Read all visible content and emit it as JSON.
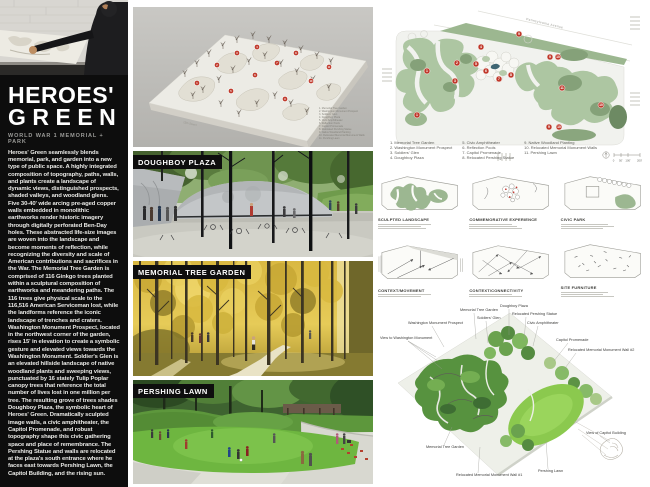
{
  "titleblock": {
    "title_line1": "HEROES'",
    "title_line2": "GREEN",
    "subtitle": "WORLD WAR 1 MEMORIAL + PARK",
    "body": "Heroes' Green seamlessly blends memorial, park, and garden into a new type of public space. A highly integrated composition of topography, paths, walls, and plants create a landscape of dynamic views, distinguished prospects, shaded valleys, and woodland glens. Five 30-40' wide arcing pre-aged copper walls embedded in monolithic earthworks render historic imagery through digitally perforated Ben-Day holes. These abstracted life-size images are woven into the landscape and become moments of reflection, while recognizing the diversity and scale of American contributions and sacrifices in the War. The Memorial Tree Garden is comprised of 116 Ginkgo trees planted within a sculptural composition of earthworks and meandering paths. The 116 trees give physical scale to the 116,516 American Serviceman lost, while the landforms reference the iconic landscape of trenches and craters. Washington Monument Prospect, located in the northwest corner of the garden, rises 15' in elevation to create a symbolic gesture and elevated views towards the Washington Monument. Soldier's Glen is an elevated hillside landscape of native woodland plants and sweeping views, punctuated by 16 stately Tulip Poplar canopy trees that reference the total number of lives lost in one million per tree. The resulting grove of trees shades Doughboy Plaza, the symbolic heart of Heroes' Green. Dramatically sculpted image walls, a civic amphitheater, the Capitol Promenade, and robust topography shape this civic gathering space and place of remembrance. The Pershing Statue and walls are relocated at the plaza's south entrance where he faces east towards Pershing Lawn, the Capitol Building, and the rising sun."
  },
  "renders": {
    "doughboy_label": "DOUGHBOY PLAZA",
    "tree_garden_label": "MEMORIAL TREE GARDEN",
    "pershing_label": "PERSHING LAWN"
  },
  "model_photo": {
    "street_caption": "15th Street",
    "markers": [
      {
        "n": "1",
        "x": 64,
        "y": 76
      },
      {
        "n": "2",
        "x": 84,
        "y": 58
      },
      {
        "n": "3",
        "x": 104,
        "y": 46
      },
      {
        "n": "4",
        "x": 124,
        "y": 40
      },
      {
        "n": "5",
        "x": 98,
        "y": 84
      },
      {
        "n": "6",
        "x": 122,
        "y": 68
      },
      {
        "n": "7",
        "x": 144,
        "y": 56
      },
      {
        "n": "8",
        "x": 163,
        "y": 46
      },
      {
        "n": "9",
        "x": 152,
        "y": 92
      },
      {
        "n": "10",
        "x": 178,
        "y": 74
      },
      {
        "n": "11",
        "x": 196,
        "y": 60
      }
    ]
  },
  "site_plan": {
    "avenue_label": "Pennsylvania Avenue",
    "legend_col1": [
      {
        "n": "1.",
        "t": "Memorial Tree Garden"
      },
      {
        "n": "2.",
        "t": "Washington Monument Prospect"
      },
      {
        "n": "3.",
        "t": "Soldiers' Glen"
      },
      {
        "n": "4.",
        "t": "Doughboy Plaza"
      }
    ],
    "legend_col2": [
      {
        "n": "5.",
        "t": "Civic Amphitheater"
      },
      {
        "n": "6.",
        "t": "Reflection Pools"
      },
      {
        "n": "7.",
        "t": "Capitol Promenade"
      },
      {
        "n": "8.",
        "t": "Relocated Pershing Statue"
      }
    ],
    "legend_col3": [
      {
        "n": "9.",
        "t": "Native Woodland Planting"
      },
      {
        "n": "10.",
        "t": "Relocated Memorial Monument Walls"
      },
      {
        "n": "11.",
        "t": "Pershing Lawn"
      }
    ],
    "scale_labels": [
      "0",
      "50'",
      "100'",
      "200'"
    ],
    "markers": [
      {
        "n": "1",
        "x": 49,
        "y": 64
      },
      {
        "n": "2",
        "x": 79,
        "y": 56
      },
      {
        "n": "3",
        "x": 77,
        "y": 74
      },
      {
        "n": "1",
        "x": 39,
        "y": 108
      },
      {
        "n": "4",
        "x": 103,
        "y": 40
      },
      {
        "n": "5",
        "x": 98,
        "y": 57
      },
      {
        "n": "6",
        "x": 108,
        "y": 64
      },
      {
        "n": "7",
        "x": 121,
        "y": 72
      },
      {
        "n": "8",
        "x": 133,
        "y": 68
      },
      {
        "n": "9",
        "x": 141,
        "y": 27
      },
      {
        "n": "9",
        "x": 172,
        "y": 50
      },
      {
        "n": "10",
        "x": 180,
        "y": 50
      },
      {
        "n": "11",
        "x": 184,
        "y": 81
      },
      {
        "n": "9",
        "x": 171,
        "y": 120
      },
      {
        "n": "10",
        "x": 181,
        "y": 120
      },
      {
        "n": "10",
        "x": 223,
        "y": 98
      }
    ]
  },
  "diagrams": {
    "row1": [
      "SCULPTED LANDSCAPE",
      "COMMEMORATIVE EXPERIENCE",
      "CIVIC PARK"
    ],
    "row2": [
      "CONTEXT/MOVEMENT",
      "CONTEXT/CONNECTIVITY",
      "SITE FURNITURE"
    ]
  },
  "perspective": {
    "callouts": [
      {
        "t": "View to Washington Monument",
        "x": 2,
        "y": 40,
        "l": [
          30,
          42,
          60,
          62
        ]
      },
      {
        "t": "Washington Monument Prospect",
        "x": 30,
        "y": 25,
        "l": [
          54,
          27,
          66,
          48
        ]
      },
      {
        "t": "Memorial Tree Garden",
        "x": 82,
        "y": 12,
        "l": [
          96,
          14,
          98,
          40
        ]
      },
      {
        "t": "Soldiers' Glen",
        "x": 99,
        "y": 20,
        "l": [
          108,
          22,
          110,
          44
        ]
      },
      {
        "t": "Doughboy Plaza",
        "x": 122,
        "y": 8,
        "l": [
          131,
          10,
          131,
          36
        ]
      },
      {
        "t": "Relocated Pershing Statue",
        "x": 134,
        "y": 16,
        "l": [
          148,
          18,
          146,
          42
        ]
      },
      {
        "t": "Civic Amphitheater",
        "x": 149,
        "y": 25,
        "l": [
          160,
          27,
          155,
          47
        ]
      },
      {
        "t": "Capitol Promenade",
        "x": 178,
        "y": 42,
        "l": [
          190,
          44,
          176,
          62
        ]
      },
      {
        "t": "Relocated Memorial Monument Wall #2",
        "x": 190,
        "y": 52,
        "l": [
          198,
          54,
          185,
          72
        ]
      },
      {
        "t": "Memorial Tree Garden",
        "x": 48,
        "y": 149,
        "l": [
          66,
          146,
          74,
          128
        ]
      },
      {
        "t": "Relocated Memorial Monument Wall #1",
        "x": 78,
        "y": 177,
        "l": [
          100,
          174,
          102,
          148
        ]
      },
      {
        "t": "Pershing Lawn",
        "x": 160,
        "y": 173,
        "l": [
          170,
          170,
          168,
          142
        ]
      },
      {
        "t": "View of Capitol Building",
        "x": 208,
        "y": 135,
        "l": [
          222,
          137,
          232,
          144
        ]
      }
    ]
  },
  "colors": {
    "panel_black": "#0d0d0d",
    "marker_red": "#c0392b",
    "plan_green": "#adc6a2",
    "plan_green_dark": "#85a179",
    "ginkgo_gold": "#d9b842",
    "lawn_green": "#6eb640"
  }
}
